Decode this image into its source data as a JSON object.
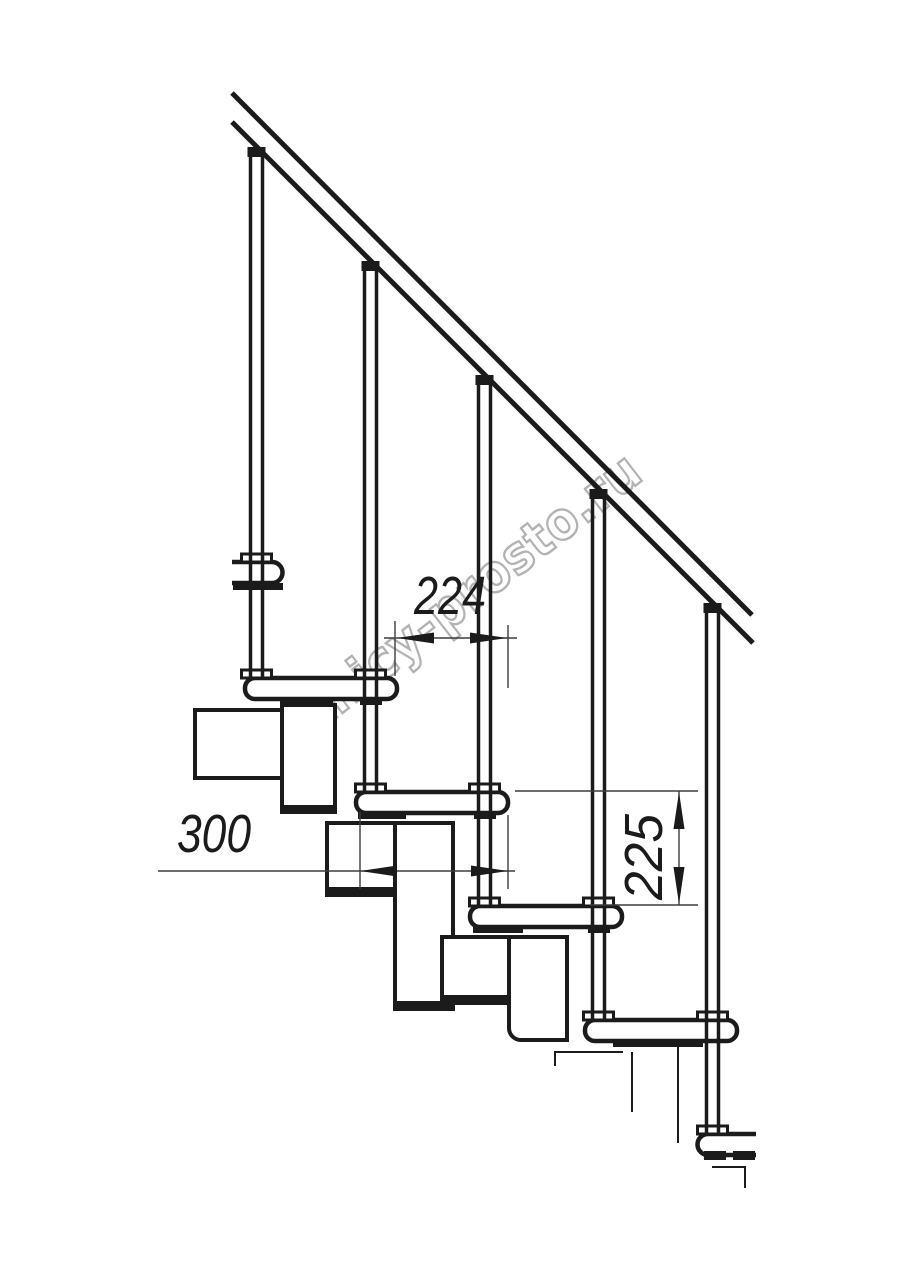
{
  "drawing": {
    "dimensions": {
      "run": "224",
      "depth": "300",
      "rise": "225"
    },
    "watermark": "lestnicy-prosto.ru",
    "colors": {
      "background": "#ffffff",
      "line": "#1b1b1b",
      "dim_line": "#3d3d3d",
      "dim_text": "#1b1b1b",
      "watermark": "#b3b3b3"
    }
  }
}
